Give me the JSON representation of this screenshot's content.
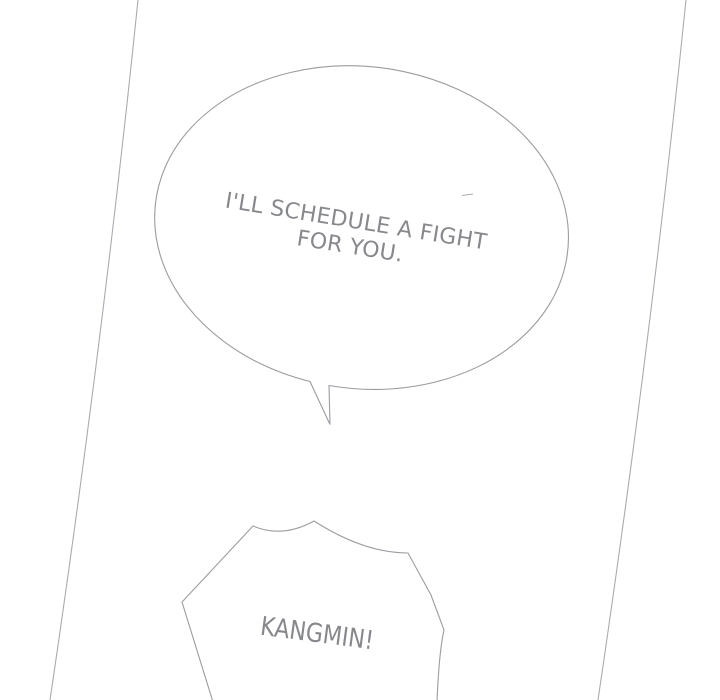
{
  "colors": {
    "background": "#ffffff",
    "panel_line": "#aaabb0",
    "bubble_line": "#9b9ca1",
    "text": "#87888c"
  },
  "speech_bubble": {
    "line1": "I'LL SCHEDULE A FIGHT",
    "line2": "FOR YOU."
  },
  "shout_bubble": {
    "line1": "KANGMIN!"
  }
}
